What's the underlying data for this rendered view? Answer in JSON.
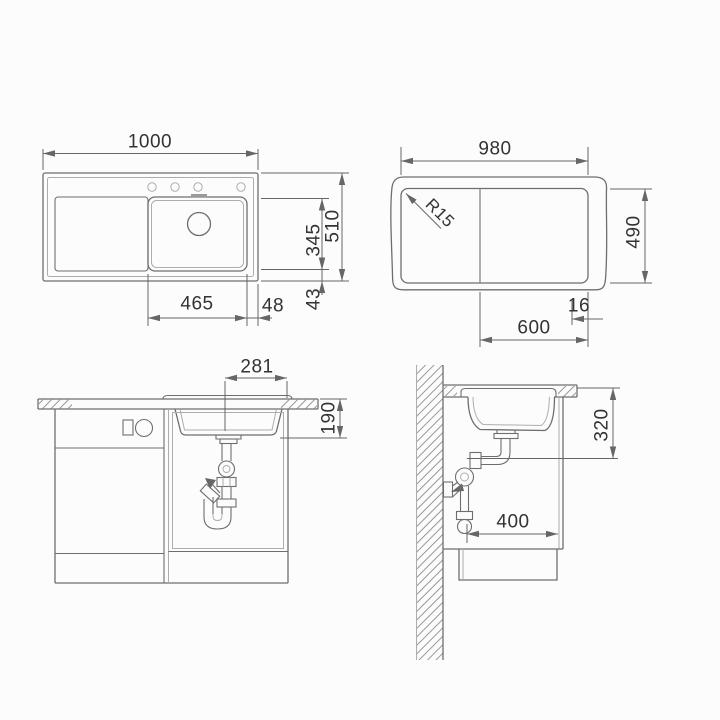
{
  "colors": {
    "background": "#fcfcfc",
    "line": "#6e6e6e",
    "line_light": "#adadad",
    "dim": "#666666",
    "text": "#333333"
  },
  "views": {
    "top_view": {
      "dims": {
        "overall_width": "1000",
        "overall_depth": "510",
        "bowl_depth": "345",
        "bowl_bottom_gap": "43",
        "bowl_width": "465",
        "bowl_right_gap": "48"
      }
    },
    "cutout_view": {
      "dims": {
        "cutout_width": "980",
        "cutout_depth": "490",
        "corner_radius": "R15",
        "bowl_zone_width": "600",
        "edge_gap": "16"
      }
    },
    "front_view": {
      "dims": {
        "drain_offset": "281",
        "bowl_inset_depth": "190"
      }
    },
    "side_view": {
      "dims": {
        "clearance_depth": "320",
        "cabinet_clearance_width": "400"
      }
    }
  }
}
